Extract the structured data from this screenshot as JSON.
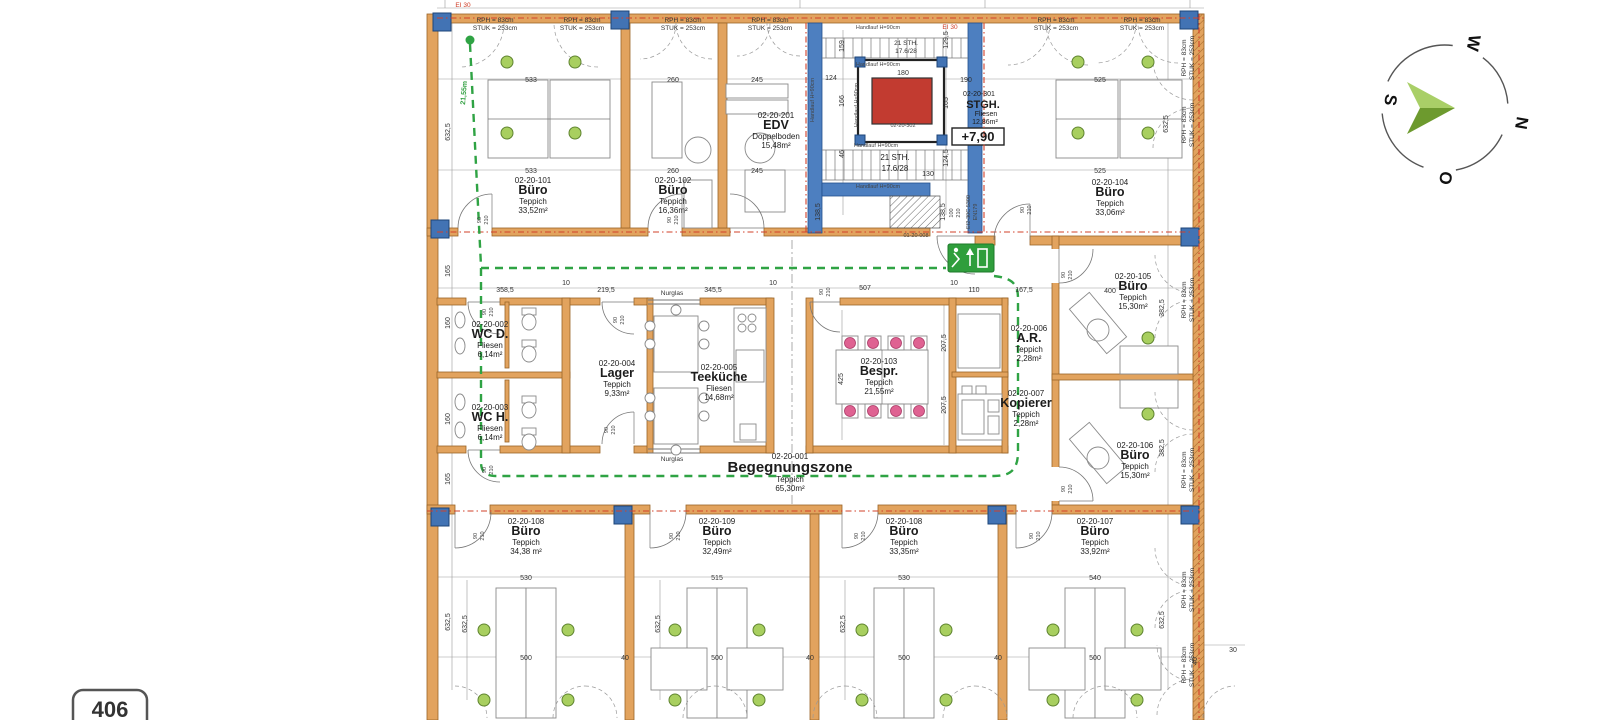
{
  "sheet": {
    "badge_label": "406",
    "fire_rating_label": "EI 30"
  },
  "compass": {
    "n": "N",
    "o": "O",
    "s": "S",
    "w": "W",
    "arrow_color_light": "#a9cf67",
    "arrow_color_dark": "#6d9a2e"
  },
  "window_head_label": {
    "line1": "RPH = 83cm",
    "line2": "STUK = 253cm"
  },
  "glass_label": "Nurglas",
  "escape_route": {
    "length": "21,55m",
    "color": "#2fa344"
  },
  "level_marker": "+7,90",
  "door_size": {
    "width": "90",
    "height": "210"
  },
  "stairwell": {
    "id": "02-20-301",
    "name": "STGH.",
    "finish": "Fliesen",
    "area": "12,86m²",
    "shaft_id": "02-20-302",
    "flight_label_1": "21 STH.",
    "flight_label_2": "17.6/28",
    "handrail_label": "Handlauf H=90cm",
    "door_id": "01-20-008",
    "door_spec_line1": "EI2-30C 5300",
    "door_spec_line2": "EN179",
    "door_width": "100",
    "door_height": "210"
  },
  "rooms": [
    {
      "id": "02-20-101",
      "name": "Büro",
      "finish": "Teppich",
      "area": "33,52m²"
    },
    {
      "id": "02-20-102",
      "name": "Büro",
      "finish": "Teppich",
      "area": "16,36m²"
    },
    {
      "id": "02-20-201",
      "name": "EDV",
      "finish": "Doppelboden",
      "area": "15,48m²"
    },
    {
      "id": "02-20-104",
      "name": "Büro",
      "finish": "Teppich",
      "area": "33,06m²"
    },
    {
      "id": "02-20-002",
      "name": "WC D.",
      "finish": "Fliesen",
      "area": "6,14m²"
    },
    {
      "id": "02-20-003",
      "name": "WC H.",
      "finish": "Fliesen",
      "area": "6,14m²"
    },
    {
      "id": "02-20-004",
      "name": "Lager",
      "finish": "Teppich",
      "area": "9,33m²"
    },
    {
      "id": "02-20-005",
      "name": "Teeküche",
      "finish": "Fliesen",
      "area": "14,68m²"
    },
    {
      "id": "02-20-103",
      "name": "Bespr.",
      "finish": "Teppich",
      "area": "21,55m²"
    },
    {
      "id": "02-20-006",
      "name": "A.R.",
      "finish": "Teppich",
      "area": "2,28m²"
    },
    {
      "id": "02-20-007",
      "name": "Kopierer",
      "finish": "Teppich",
      "area": "2,28m²"
    },
    {
      "id": "02-20-105",
      "name": "Büro",
      "finish": "Teppich",
      "area": "15,30m²"
    },
    {
      "id": "02-20-106",
      "name": "Büro",
      "finish": "Teppich",
      "area": "15,30m²"
    },
    {
      "id": "02-20-001",
      "name": "Begegnungszone",
      "finish": "Teppich",
      "area": "65,30m²"
    },
    {
      "id": "02-20-108",
      "name": "Büro",
      "finish": "Teppich",
      "area": "34,38 m²"
    },
    {
      "id": "02-20-109",
      "name": "Büro",
      "finish": "Teppich",
      "area": "32,49m²"
    },
    {
      "id": "02-20-108",
      "name": "Büro",
      "finish": "Teppich",
      "area": "33,35m²"
    },
    {
      "id": "02-20-107",
      "name": "Büro",
      "finish": "Teppich",
      "area": "33,92m²"
    }
  ],
  "dims": {
    "top_widths": [
      "533",
      "260",
      "245",
      "525"
    ],
    "mid_row": [
      "358,5",
      "219,5",
      "345,5",
      "507",
      "110",
      "167,5",
      "400"
    ],
    "small_gap": "10",
    "bottom_widths": [
      "530",
      "515",
      "530",
      "540"
    ],
    "bottom_inner_width": "500",
    "bottom_gap": "40",
    "right_edge_tick": "30",
    "left_col": [
      "632,5",
      "165",
      "160",
      "160",
      "165",
      "632,5"
    ],
    "right_col": [
      "632,5",
      "382,5",
      "382,5",
      "632,5"
    ],
    "room_depth": "632,5",
    "stair": {
      "s1": "129,5",
      "s2": "165",
      "s3": "124,5",
      "s4": "138,5",
      "s5": "159",
      "s6": "166",
      "s7": "46",
      "s8": "124",
      "s9": "180",
      "s10": "190",
      "s11": "130"
    },
    "bespr": {
      "depth": "425",
      "side": "207,5"
    }
  }
}
